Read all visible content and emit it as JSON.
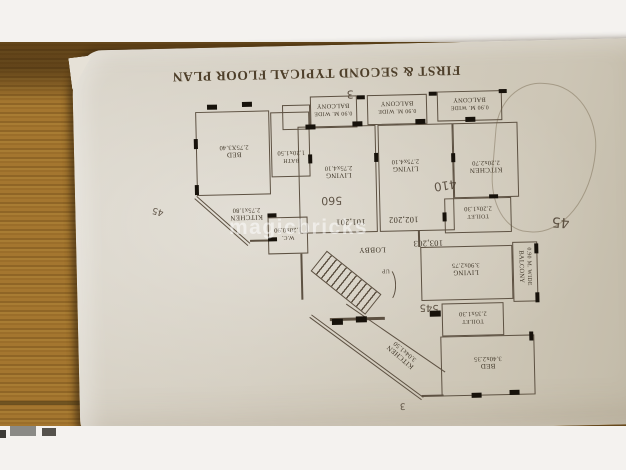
{
  "title": "FIRST & SECOND TYPICAL FLOOR PLAN",
  "watermark": "magicbricks",
  "balcony": {
    "line1": "0.90 M. WIDE",
    "line2": "BALCONY"
  },
  "rooms": [
    {
      "name": "BED",
      "dims": "2.75X3.40"
    },
    {
      "name": "BATH",
      "dims": "1.20x1.50"
    },
    {
      "name": "LIVING",
      "dims": "2.75x4.10"
    },
    {
      "name": "LIVING",
      "dims": "2.75x4.10"
    },
    {
      "name": "KITCHEN",
      "dims": "2.75x1.80"
    },
    {
      "name": "W.C.",
      "dims": "1.20x0.90"
    },
    {
      "name": "KITCHEN",
      "dims": "2.20x2.70"
    },
    {
      "name": "TOILET",
      "dims": "2.20x1.30"
    },
    {
      "name": "LIVING",
      "dims": "3.90x2.75"
    },
    {
      "name": "TOILET",
      "dims": "2.35x1.30"
    },
    {
      "name": "BED",
      "dims": "3.40x2.35"
    },
    {
      "name": "KITCHEN",
      "dims": "3.04x1.50"
    }
  ],
  "units": [
    "101,201",
    "102,202",
    "103,203"
  ],
  "lobby": "LOBBY",
  "up": "UP",
  "handwritten": {
    "n560": "560",
    "n410": "410",
    "n45a": "45",
    "n45b": "45",
    "n545": "545",
    "n3a": "3",
    "n3b": "3"
  }
}
